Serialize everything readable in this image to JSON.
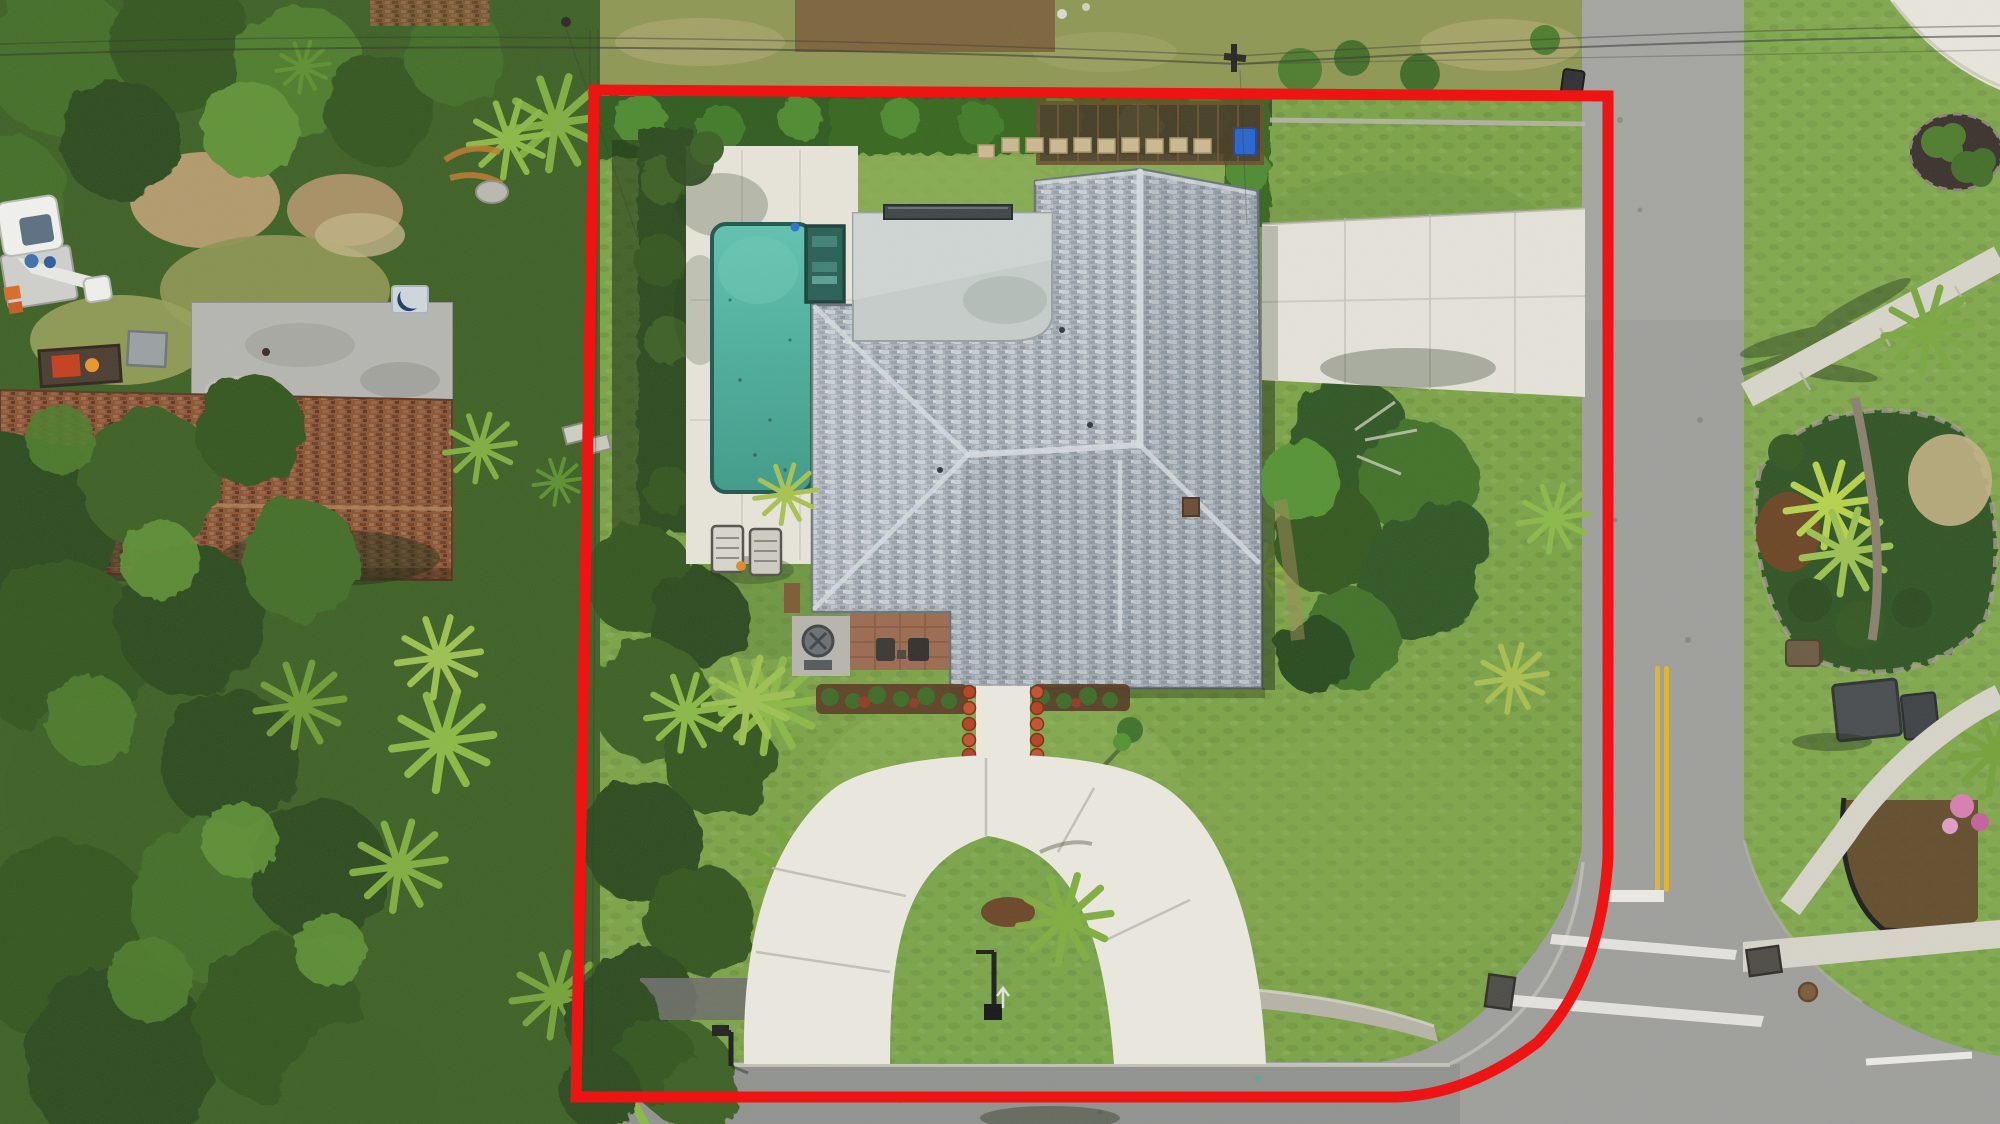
{
  "meta": {
    "type": "aerial-drone-photo",
    "subject": "top-down aerial photo of a single-family home lot outlined with a red property boundary"
  },
  "colors": {
    "boundary_red": "#ee1414",
    "asphalt": "#9e9f9b",
    "asphalt_shaded": "#858783",
    "concrete": "#ece9e0",
    "deck": "#e8e5da",
    "grass_lot": "#7ba346",
    "grass_neighbor": "#7fa84b",
    "scrub": "#8e9752",
    "canopy_dark": "#2c4a1c",
    "canopy_mid": "#426d27",
    "canopy_light": "#5f9234",
    "palm_bright": "#8ab944",
    "hedge": "#35661f",
    "pool_water_light": "#5ec0ad",
    "pool_water_deep": "#3e9a88",
    "spa": "#275e53",
    "roof_shingle_base": "#a9b2b9",
    "flat_roof": "#c6cdca",
    "neighbor_roof": "#8a5334",
    "double_yellow": "#e0b62a",
    "road_marking_white": "#eceae4",
    "recycle_bin": "#2563cc",
    "truck_white": "#f2f2ef",
    "truck_orange": "#d96a26",
    "flower_pot": "#b5401f",
    "mulch": "#5a3a22",
    "pink_flowers": "#d77fb0"
  },
  "boundary": {
    "path": "M594,90 L1608,96 L1608,858 Q1600,978 1538,1042 Q1468,1095 1396,1097 L576,1097 Z",
    "stroke_width": "11"
  },
  "features": [
    "red property boundary outline",
    "gray hip-roof house",
    "flat gray garage roof",
    "dark skylight strip",
    "turquoise swimming pool",
    "attached dark spa",
    "white pool deck",
    "two lounge chairs",
    "horseshoe circular driveway",
    "grass island with small palm and mulch ring",
    "front walkway lined with red potted flowers",
    "side concrete parking pad",
    "north hedge with pergola and stepping stones",
    "blue recycling bin",
    "utility pole and overhead wires",
    "vertical street with double yellow centerline",
    "stop bar and white intersection markings",
    "street intersection with curved curb",
    "bottom street with gutter seam",
    "black mailbox posts",
    "old dark asphalt path",
    "neighbor house with brown shingle roof",
    "neighbor flat roof with crescent skylight",
    "white utility bucket truck",
    "equipment trailer with red machine",
    "dense tree canopy",
    "saw palmetto fan palms",
    "across-street lawn with tropical garden beds",
    "coconut palm crowns",
    "gray utility cabinets",
    "storm drain grates",
    "manhole cover",
    "corner sidewalks",
    "pink flowering shrub",
    "black landscape edging",
    "blue utility paint mark",
    "black trash bin at curb"
  ]
}
